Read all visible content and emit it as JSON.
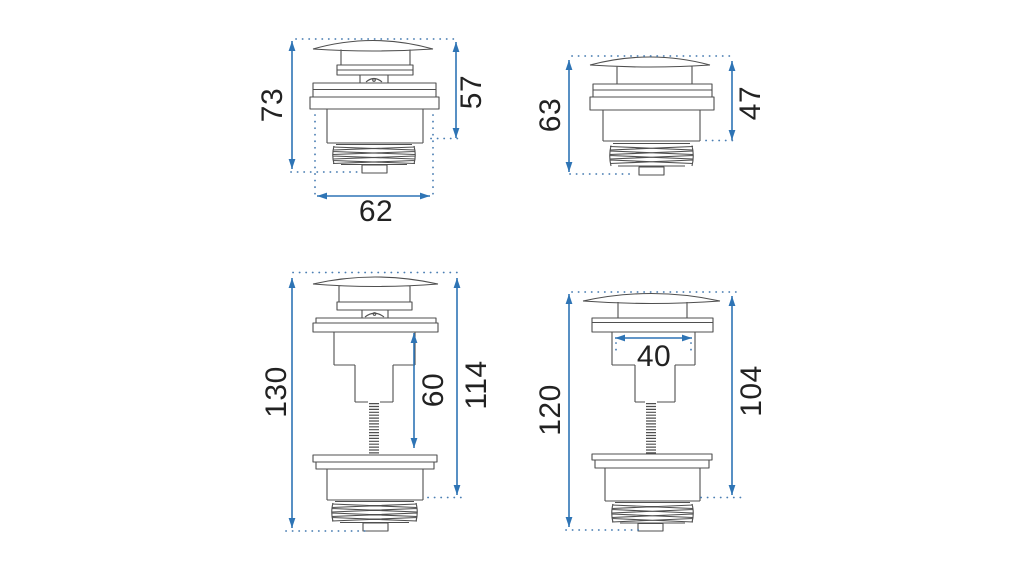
{
  "page": {
    "background": "#ffffff",
    "description": "Technical dimension drawing of four click-clack basin waste drain valves"
  },
  "colors": {
    "dimension_blue": "#2e74b5",
    "extension_dot_blue": "#4c7fb3",
    "outline_gray": "#4f4f4f",
    "label_text": "#222222"
  },
  "figures": [
    {
      "position": "top-left",
      "labels": {
        "total_height": "73",
        "body_height": "57",
        "width": "62"
      }
    },
    {
      "position": "top-right",
      "labels": {
        "total_height": "63",
        "body_height": "47"
      }
    },
    {
      "position": "bottom-left",
      "labels": {
        "total_height": "130",
        "rod_length": "60",
        "body_height": "114"
      }
    },
    {
      "position": "bottom-right",
      "labels": {
        "total_height": "120",
        "cap_width": "40",
        "body_height": "104"
      }
    }
  ]
}
